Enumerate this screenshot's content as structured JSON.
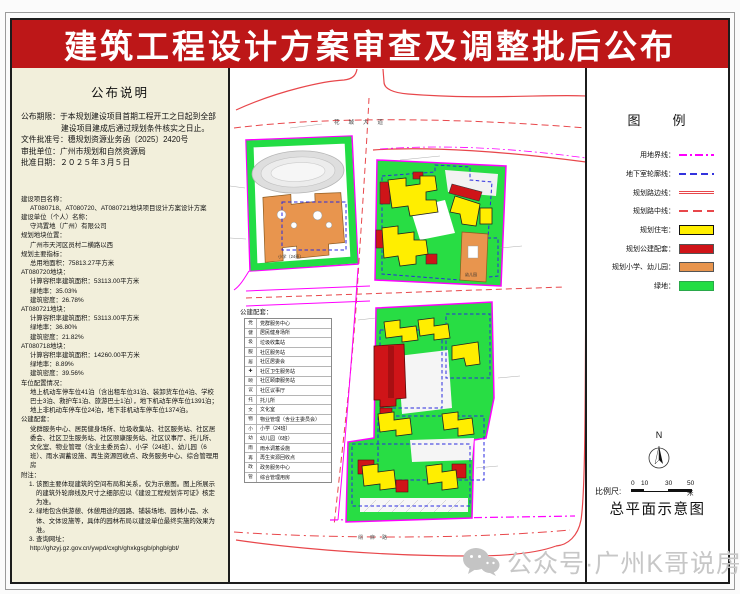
{
  "title": "建筑工程设计方案审查及调整批后公布",
  "colors": {
    "title_bar": "#bd1718",
    "left_panel_bg": "#f2efdb",
    "boundary_magenta": "#ff00ff",
    "road_red": "#e8474b",
    "basement_blue": "#3333dd",
    "residential_yellow": "#ffee00",
    "public_red": "#cf1418",
    "school_orange": "#e8954e",
    "green": "#22dd44",
    "watermark_gray": "#c7c7c7"
  },
  "notice": {
    "heading": "公布说明",
    "rows": [
      {
        "label": "公布期限：",
        "text": "于本规划建设项目首期工程开工之日起到全部建设项目建成后通过规划条件核实之日止。"
      },
      {
        "label": "文件批准号：",
        "text": "穗规划资源业务函〔2025〕2420号"
      },
      {
        "label": "审批单位：",
        "text": "广州市规划和自然资源局"
      },
      {
        "label": "批准日期：",
        "text": "２０２５年３月５日"
      }
    ]
  },
  "details": {
    "lines": [
      {
        "c": "h",
        "t": "建设项目名称："
      },
      {
        "c": "v",
        "t": "AT080718、AT080720、AT080721地块项目设计方案设计方案"
      },
      {
        "c": "h",
        "t": "建设单位（个人）名称："
      },
      {
        "c": "v",
        "t": "守鸿置地（广州）有限公司"
      },
      {
        "c": "h",
        "t": "规划地块位置："
      },
      {
        "c": "v",
        "t": "广州市天河区员村二横路以西"
      },
      {
        "c": "h",
        "t": "规划主要指标："
      },
      {
        "c": "v",
        "t": "总用地面积：75813.27平方米"
      },
      {
        "c": "h",
        "t": "AT080720地块："
      },
      {
        "c": "v",
        "t": "计算容积率建筑面积：53113.00平方米"
      },
      {
        "c": "v",
        "t": "绿地率：35.03%"
      },
      {
        "c": "v",
        "t": "建筑密度：26.78%"
      },
      {
        "c": "h",
        "t": "AT080721地块："
      },
      {
        "c": "v",
        "t": "计算容积率建筑面积：53113.00平方米"
      },
      {
        "c": "v",
        "t": "绿地率：36.80%"
      },
      {
        "c": "v",
        "t": "建筑密度：21.82%"
      },
      {
        "c": "h",
        "t": "AT080718地块："
      },
      {
        "c": "v",
        "t": "计算容积率建筑面积：14260.00平方米"
      },
      {
        "c": "v",
        "t": "绿地率：8.89%"
      },
      {
        "c": "v",
        "t": "建筑密度：39.56%"
      },
      {
        "c": "h",
        "t": "车位配置情况："
      },
      {
        "c": "p",
        "t": "地上机动车停车位41泊（含出租车位31泊、装卸货车位4泊、学校巴士3泊、救护车1泊、旅游巴士1泊），地下机动车停车位1391泊；地上非机动车停车位24泊，地下非机动车停车位1374泊。"
      },
      {
        "c": "h",
        "t": "公建配套："
      },
      {
        "c": "p",
        "t": "党群服务中心、居民健身场所、垃圾收集站、社区服务站、社区居委会、社区卫生服务站、社区颐康服务站、社区议事厅、托儿所、文化室、物业管理（含业主委员会）、小学（24班）、幼儿园（6班）、雨水调蓄设施、再生资源回收点、政务服务中心、综合管理用房"
      },
      {
        "c": "h",
        "t": "附注："
      },
      {
        "c": "n",
        "t": "1. 该图主要体现建筑的空间布局和关系，仅为示意图。图上所展示的建筑外轮廓线及尺寸之细部应以《建设工程规划许可证》核定为准。"
      },
      {
        "c": "n",
        "t": "2. 绿地包含供游憩、休憩用途的园路、铺装场地、园林小品、水体、文体设施等，具体的园林布局以建设单位最终实施的效果为准。"
      },
      {
        "c": "n",
        "t": "3. 查询网址："
      },
      {
        "c": "v",
        "t": "http://ghzyj.gz.gov.cn/ywpd/cxgh/ghxkgsgb/phgb/gbt/"
      }
    ]
  },
  "facilities": {
    "heading": "公建配套：",
    "rows": [
      {
        "icon": "党",
        "label": "党群服务中心"
      },
      {
        "icon": "健",
        "label": "居民健身场所"
      },
      {
        "icon": "圾",
        "label": "垃圾收集站"
      },
      {
        "icon": "服",
        "label": "社区服务站"
      },
      {
        "icon": "居",
        "label": "社区居委会"
      },
      {
        "icon": "✚",
        "label": "社区卫生服务站"
      },
      {
        "icon": "颐",
        "label": "社区颐康服务站"
      },
      {
        "icon": "议",
        "label": "社区议事厅"
      },
      {
        "icon": "托",
        "label": "托儿所"
      },
      {
        "icon": "文",
        "label": "文化室"
      },
      {
        "icon": "物",
        "label": "物业管理（含业主委员会）"
      },
      {
        "icon": "小",
        "label": "小学（24班）"
      },
      {
        "icon": "幼",
        "label": "幼儿园（6班）"
      },
      {
        "icon": "雨",
        "label": "雨水调蓄设施"
      },
      {
        "icon": "再",
        "label": "再生资源回收点"
      },
      {
        "icon": "政",
        "label": "政务服务中心"
      },
      {
        "icon": "管",
        "label": "综合管理用房"
      }
    ]
  },
  "legend": {
    "title": "图　　例",
    "items": [
      {
        "label": "用地界线：",
        "s": "boundary"
      },
      {
        "label": "地下室轮廓线：",
        "s": "basement"
      },
      {
        "label": "规划路边线：",
        "s": "redge"
      },
      {
        "label": "规划路中线：",
        "s": "rcenter"
      },
      {
        "label": "规划住宅：",
        "s": "swres"
      },
      {
        "label": "规划公建配套：",
        "s": "swpub"
      },
      {
        "label": "规划小学、幼儿园：",
        "s": "swsch"
      },
      {
        "label": "绿地：",
        "s": "swgrn"
      }
    ]
  },
  "map": {
    "road_top": "花城大道",
    "road_bottom": "绢麻路",
    "school_label": "小学（24班）",
    "kindergarten_label": "幼儿园"
  },
  "compass": {
    "label": "N"
  },
  "scale": {
    "label": "比例尺:",
    "ticks": [
      "0",
      "10",
      "30",
      "50米"
    ]
  },
  "plan_title": "总平面示意图",
  "watermark": {
    "text": "公众号·广州K哥说房"
  }
}
